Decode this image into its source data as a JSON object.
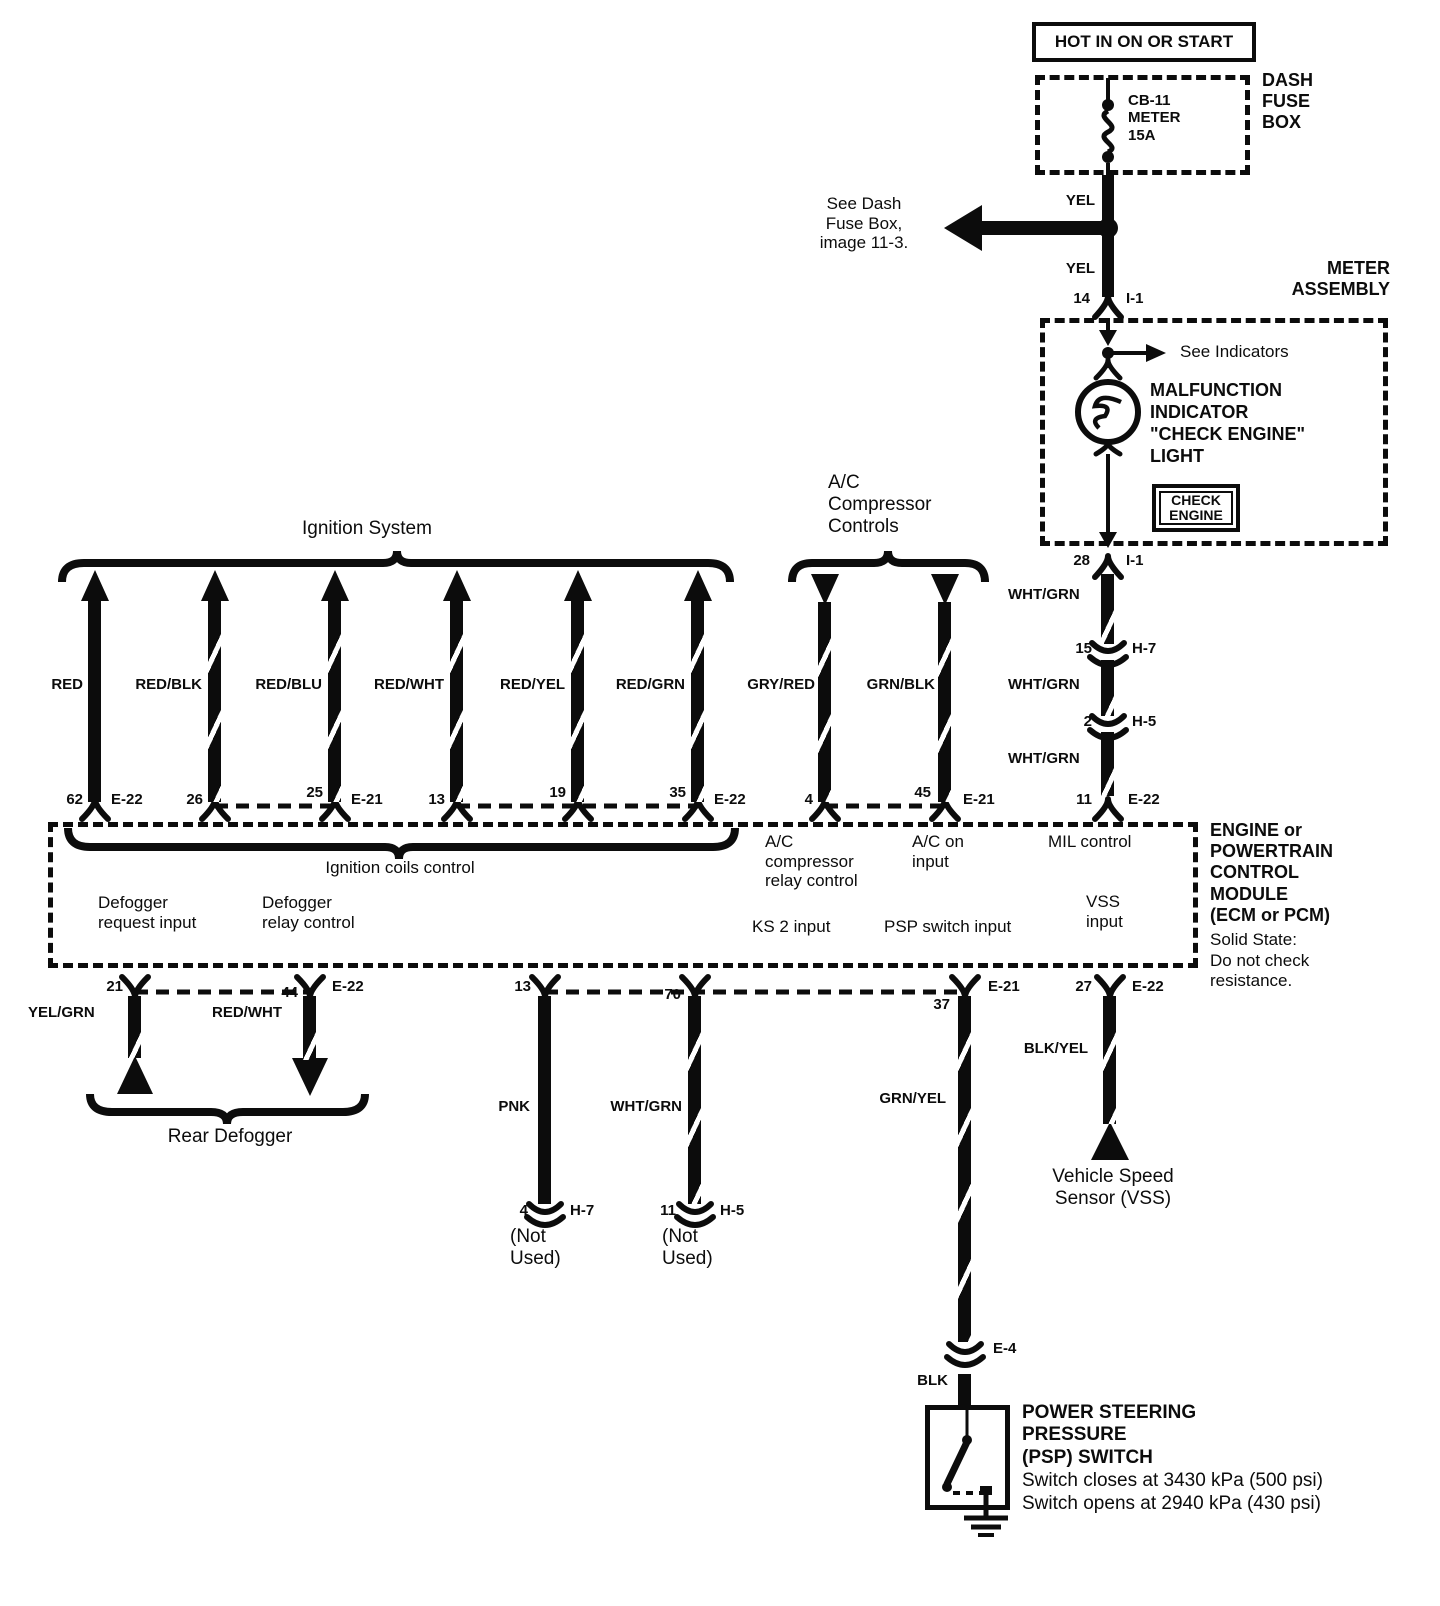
{
  "power": {
    "hot_label": "HOT IN ON OR START",
    "box_name": "DASH\nFUSE\nBOX",
    "breaker_label": "CB-11\nMETER\n15A",
    "wire_color_upper": "YEL",
    "wire_color_lower": "YEL",
    "see_note": "See Dash\nFuse Box,\nimage 11-3.",
    "pin": "14",
    "conn": "I-1"
  },
  "meter": {
    "box_name": "METER\nASSEMBLY",
    "see_indicators": "See Indicators",
    "mil_light_label": "MALFUNCTION\nINDICATOR\n\"CHECK ENGINE\"\nLIGHT",
    "badge": "CHECK\nENGINE",
    "out_pin": "28",
    "out_conn": "I-1"
  },
  "mil_path": {
    "wire_color_1": "WHT/GRN",
    "pin_15": "15",
    "conn_h7": "H-7",
    "wire_color_2": "WHT/GRN",
    "pin_2": "2",
    "conn_h5": "H-5",
    "wire_color_3": "WHT/GRN",
    "pin_11": "11",
    "conn_e22": "E-22"
  },
  "ignition": {
    "title": "Ignition System",
    "wires": [
      {
        "color": "RED",
        "pin": "62",
        "conn": "E-22"
      },
      {
        "color": "RED/BLK",
        "pin": "26",
        "conn": ""
      },
      {
        "color": "RED/BLU",
        "pin": "25",
        "conn": "E-21"
      },
      {
        "color": "RED/WHT",
        "pin": "13",
        "conn": ""
      },
      {
        "color": "RED/YEL",
        "pin": "19",
        "conn": ""
      },
      {
        "color": "RED/GRN",
        "pin": "35",
        "conn": "E-22"
      }
    ]
  },
  "ac": {
    "title": "A/C\nCompressor\nControls",
    "wire_1_color": "GRY/RED",
    "wire_2_color": "GRN/BLK",
    "pin_4": "4",
    "pin_45": "45",
    "conn": "E-21"
  },
  "ecm": {
    "name": "ENGINE or\nPOWERTRAIN\nCONTROL\nMODULE\n(ECM or PCM)",
    "note": "Solid State:\nDo not check\nresistance.",
    "coils_label": "Ignition coils control",
    "ac_relay_label": "A/C\ncompressor\nrelay control",
    "ac_on_label": "A/C on\ninput",
    "mil_label": "MIL control",
    "defog_request_label": "Defogger\nrequest input",
    "defog_relay_label": "Defogger\nrelay control",
    "ks2_label": "KS 2 input",
    "psp_label": "PSP switch input",
    "vss_label": "VSS\ninput"
  },
  "defogger": {
    "pin_21": "21",
    "pin_44": "44",
    "conn": "E-22",
    "wire_left_color": "YEL/GRN",
    "wire_right_color": "RED/WHT",
    "title": "Rear Defogger"
  },
  "unused": {
    "pin_13": "13",
    "wire_1_color": "PNK",
    "end_1_pin": "4",
    "end_1_conn": "H-7",
    "end_1_note": "(Not\nUsed)",
    "pin_70": "70",
    "wire_2_color": "WHT/GRN",
    "end_2_pin": "11",
    "end_2_conn": "H-5",
    "end_2_note": "(Not\nUsed)"
  },
  "psp": {
    "pin": "37",
    "conn": "E-21",
    "wire_color": "GRN/YEL",
    "conn_e4": "E-4",
    "wire_color_2": "BLK",
    "name": "POWER STEERING\nPRESSURE\n(PSP) SWITCH",
    "note_close": "Switch closes at 3430 kPa (500 psi)",
    "note_open": "Switch opens at 2940 kPa (430 psi)"
  },
  "vss": {
    "pin": "27",
    "conn": "E-22",
    "wire_color": "BLK/YEL",
    "label": "Vehicle Speed\nSensor (VSS)"
  }
}
